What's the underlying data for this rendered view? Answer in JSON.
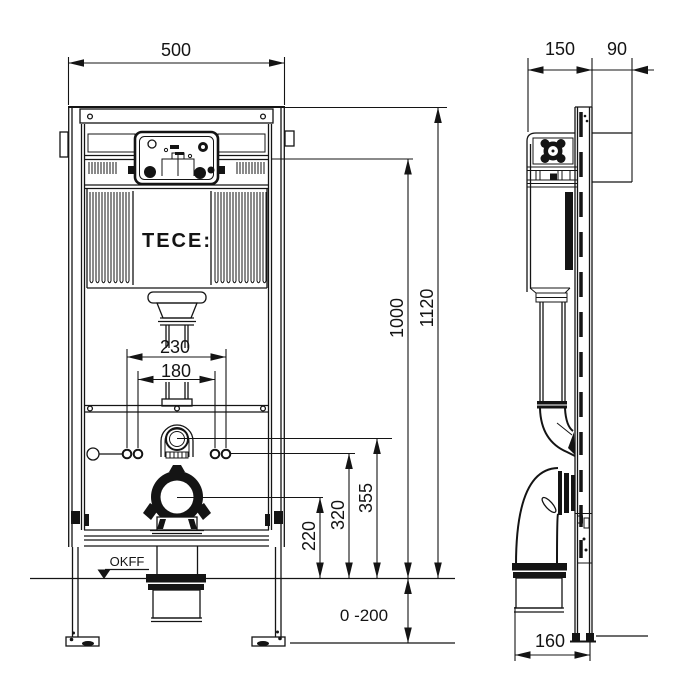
{
  "front_view": {
    "logo": "TECE:",
    "floor_label": "OKFF",
    "dim_width": "500",
    "dim_flush_outer": "230",
    "dim_flush_inner": "180",
    "dim_drain": "220",
    "dim_fixing": "320",
    "dim_water": "355",
    "dim_actuation": "1000",
    "dim_total": "1120",
    "dim_floor": "0 -200"
  },
  "side_view": {
    "dim_depth": "150",
    "dim_offset": "90",
    "dim_outlet": "160"
  },
  "colors": {
    "line": "#141414",
    "background": "#ffffff"
  }
}
